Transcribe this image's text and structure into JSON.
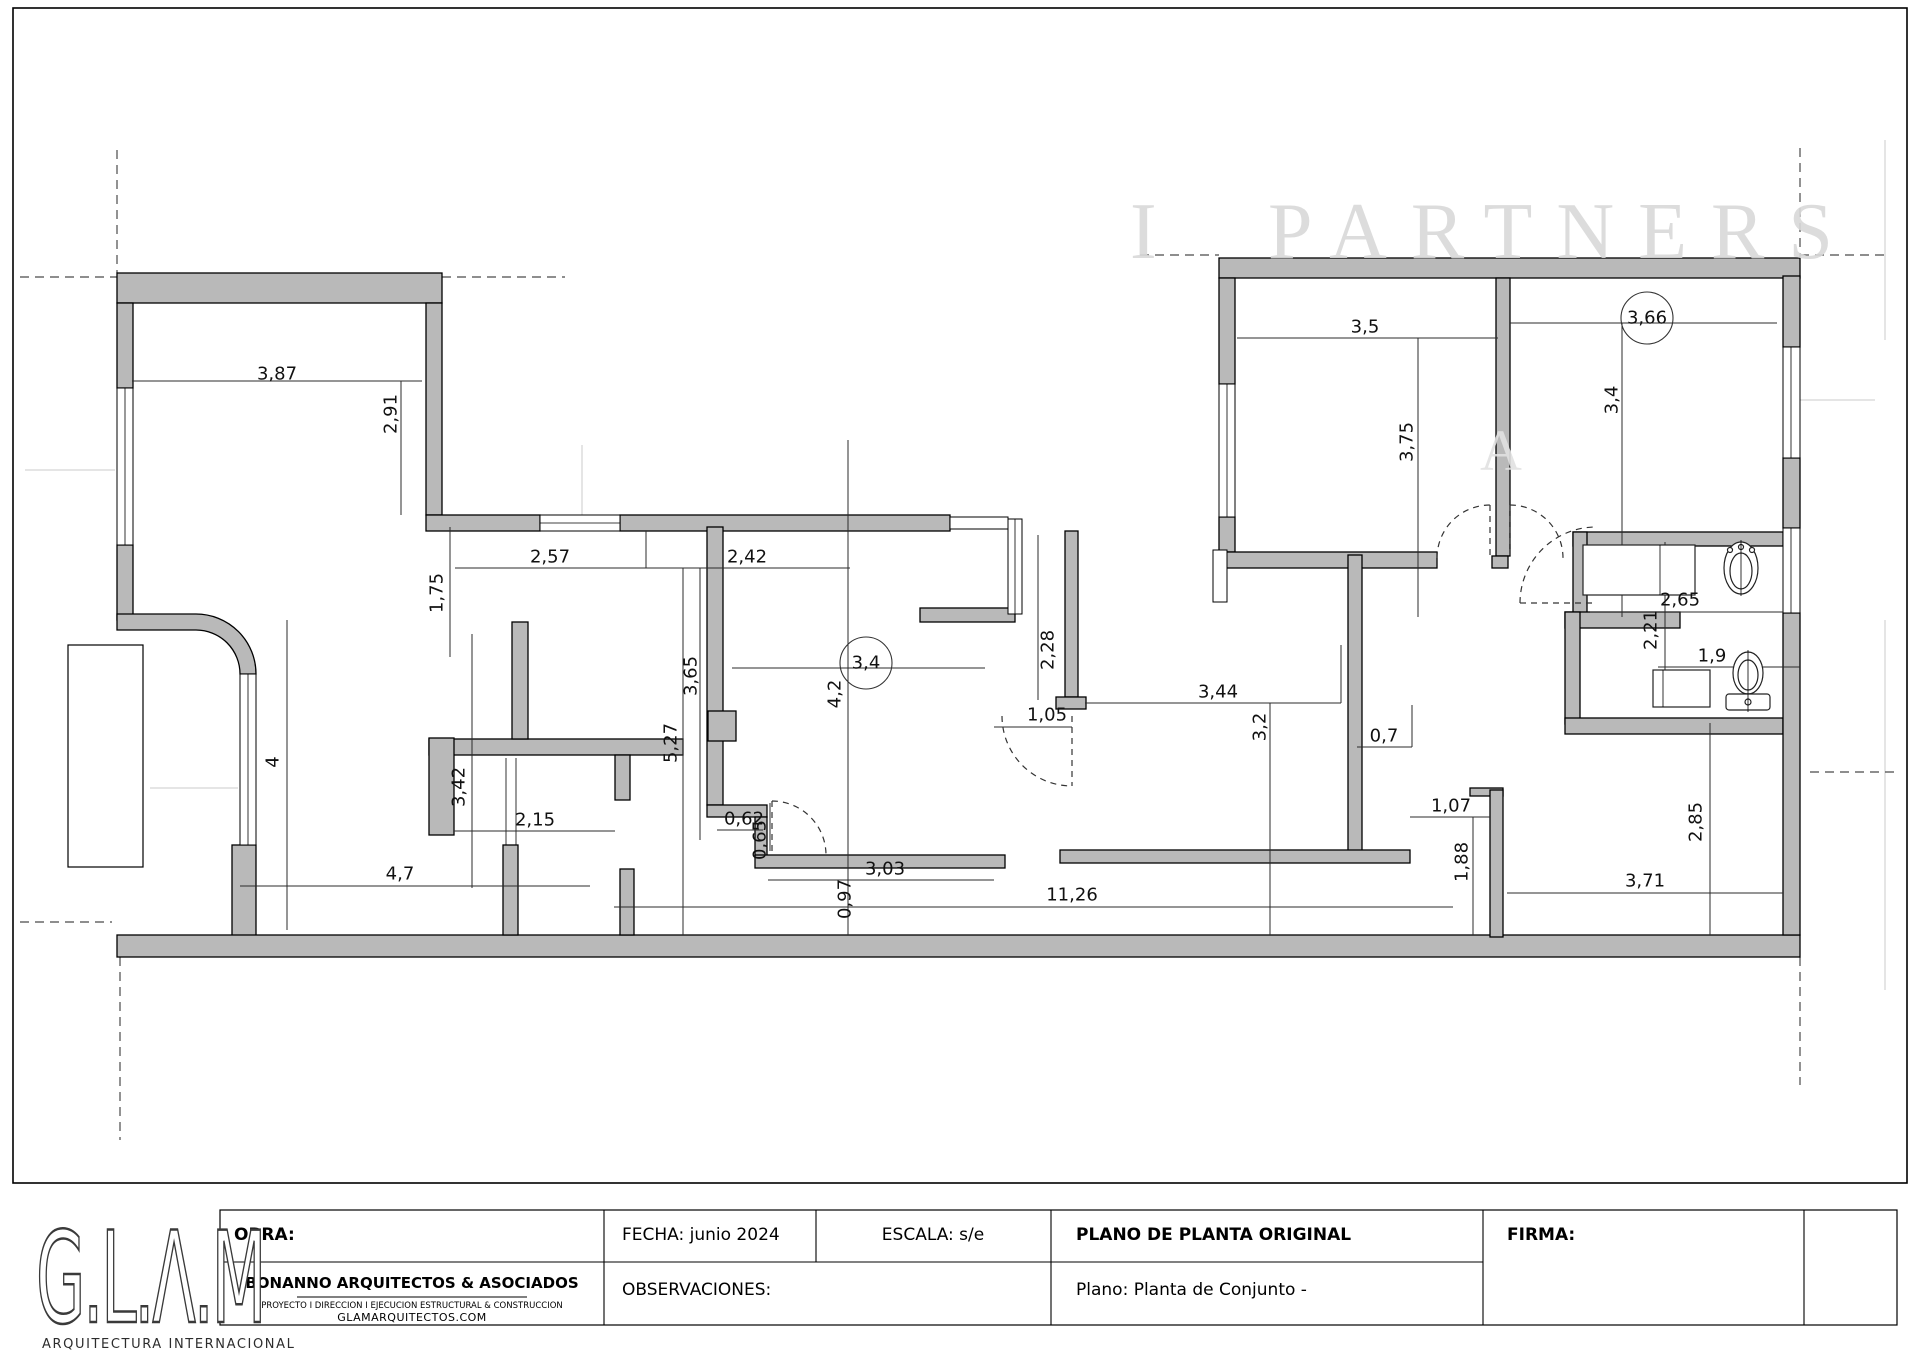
{
  "watermark": {
    "text": "PARTNERS",
    "partial": "A"
  },
  "logo": {
    "name": "G.L.Λ.M",
    "subtitle": "ARQUITECTURA INTERNACIONAL"
  },
  "title_block": {
    "obra_label": "OBRA:",
    "fecha": "FECHA: junio 2024",
    "escala": "ESCALA: s/e",
    "plano_title": "PLANO DE PLANTA ORIGINAL",
    "firma_label": "FIRMA:",
    "observaciones_label": "OBSERVACIONES:",
    "plano_name": "Plano: Planta de Conjunto -",
    "company_name": "BONANNO ARQUITECTOS & ASOCIADOS",
    "company_tagline": "PROYECTO I DIRECCION I EJECUCION ESTRUCTURAL & CONSTRUCCION",
    "company_website": "GLAMARQUITECTOS.COM"
  },
  "plan": {
    "wall_color": "#b9b9b9",
    "watermark_color": "#d9d9d9",
    "dimensions": [
      {
        "text": "3,87",
        "x": 277,
        "y": 374,
        "rot": 0
      },
      {
        "text": "2,91",
        "x": 391,
        "y": 414,
        "rot": 90
      },
      {
        "text": "1,75",
        "x": 437,
        "y": 593,
        "rot": 90
      },
      {
        "text": "2,57",
        "x": 550,
        "y": 557,
        "rot": 0
      },
      {
        "text": "2,42",
        "x": 747,
        "y": 557,
        "rot": 0
      },
      {
        "text": "3,65",
        "x": 691,
        "y": 676,
        "rot": 90
      },
      {
        "text": "5,27",
        "x": 671,
        "y": 743,
        "rot": 90
      },
      {
        "text": "4,2",
        "x": 835,
        "y": 694,
        "rot": 90
      },
      {
        "text": "2,15",
        "x": 535,
        "y": 820,
        "rot": 0
      },
      {
        "text": "4",
        "x": 273,
        "y": 762,
        "rot": 90
      },
      {
        "text": "3,42",
        "x": 459,
        "y": 787,
        "rot": 90
      },
      {
        "text": "4,7",
        "x": 400,
        "y": 874,
        "rot": 0
      },
      {
        "text": "0,62",
        "x": 744,
        "y": 819,
        "rot": 0
      },
      {
        "text": "0,65",
        "x": 760,
        "y": 840,
        "rot": 90
      },
      {
        "text": "3,03",
        "x": 885,
        "y": 869,
        "rot": 0
      },
      {
        "text": "0,97",
        "x": 845,
        "y": 899,
        "rot": 90
      },
      {
        "text": "11,26",
        "x": 1072,
        "y": 895,
        "rot": 0
      },
      {
        "text": "3,4",
        "x": 866,
        "y": 663,
        "rot": 0,
        "circled": true
      },
      {
        "text": "2,28",
        "x": 1048,
        "y": 650,
        "rot": 90
      },
      {
        "text": "1,05",
        "x": 1047,
        "y": 715,
        "rot": 0
      },
      {
        "text": "3,44",
        "x": 1218,
        "y": 692,
        "rot": 0
      },
      {
        "text": "3,2",
        "x": 1260,
        "y": 727,
        "rot": 90
      },
      {
        "text": "0,7",
        "x": 1384,
        "y": 736,
        "rot": 0
      },
      {
        "text": "1,07",
        "x": 1451,
        "y": 806,
        "rot": 0
      },
      {
        "text": "1,88",
        "x": 1462,
        "y": 862,
        "rot": 90
      },
      {
        "text": "3,71",
        "x": 1645,
        "y": 881,
        "rot": 0
      },
      {
        "text": "2,85",
        "x": 1696,
        "y": 822,
        "rot": 90
      },
      {
        "text": "2,65",
        "x": 1680,
        "y": 600,
        "rot": 0
      },
      {
        "text": "2,21",
        "x": 1651,
        "y": 630,
        "rot": 90
      },
      {
        "text": "1,9",
        "x": 1712,
        "y": 656,
        "rot": 0
      },
      {
        "text": "3,5",
        "x": 1365,
        "y": 327,
        "rot": 0
      },
      {
        "text": "3,75",
        "x": 1407,
        "y": 442,
        "rot": 90
      },
      {
        "text": "3,66",
        "x": 1647,
        "y": 318,
        "rot": 0,
        "circled": true
      },
      {
        "text": "3,4",
        "x": 1612,
        "y": 400,
        "rot": 90
      }
    ]
  }
}
